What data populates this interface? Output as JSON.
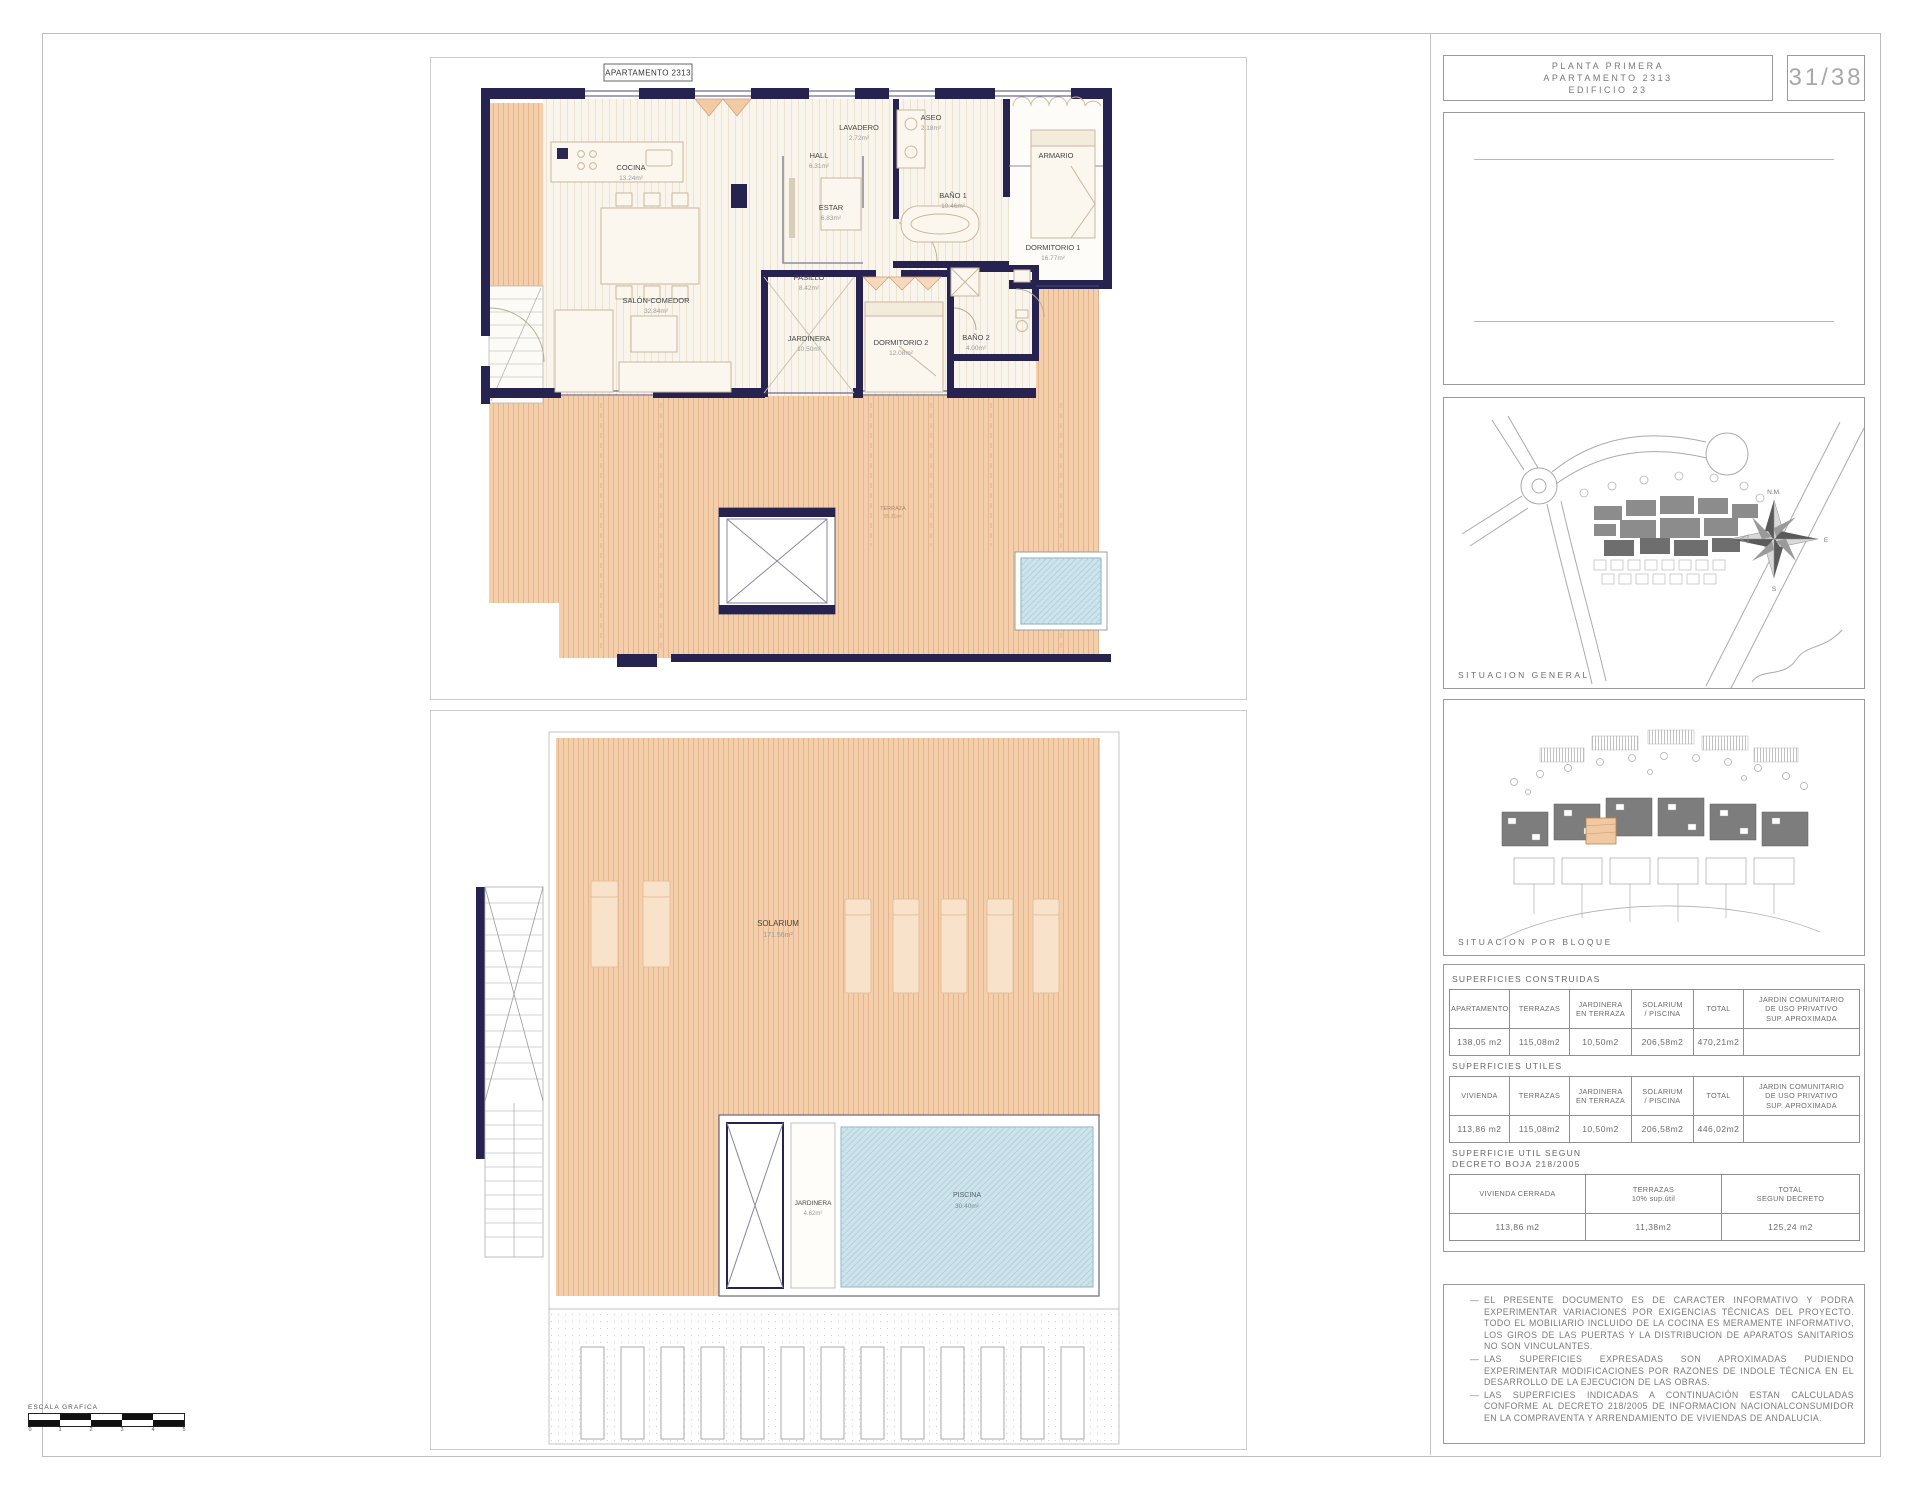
{
  "title_block": {
    "line1": "PLANTA  PRIMERA",
    "line2": "APARTAMENTO    2313",
    "line3": "EDIFICIO  23",
    "page": "31/38"
  },
  "plan1": {
    "tag": "APARTAMENTO 2313",
    "rooms": [
      {
        "name": "COCINA",
        "area": "13.24m²"
      },
      {
        "name": "HALL",
        "area": "6.31m²"
      },
      {
        "name": "LAVADERO",
        "area": "2.72m²"
      },
      {
        "name": "ASEO",
        "area": "2.18m²"
      },
      {
        "name": "ESTAR",
        "area": "6.83m²"
      },
      {
        "name": "BAÑO 1",
        "area": "10.46m²"
      },
      {
        "name": "ARMARIO",
        "area": ""
      },
      {
        "name": "DORMITORIO 1",
        "area": "16.77m²"
      },
      {
        "name": "PASILLO",
        "area": "8.42m²"
      },
      {
        "name": "SALÓN-COMEDOR",
        "area": "32.84m²"
      },
      {
        "name": "JARDINERA",
        "area": "10.50m²"
      },
      {
        "name": "DORMITORIO 2",
        "area": "12.08m²"
      },
      {
        "name": "BAÑO 2",
        "area": "4.00m²"
      },
      {
        "name": "TERRAZA",
        "area": "95.31m²"
      }
    ]
  },
  "plan2": {
    "rooms": [
      {
        "name": "SOLARIUM",
        "area": "171.56m²"
      },
      {
        "name": "JARDINERA",
        "area": "4.62m²"
      },
      {
        "name": "PISCINA",
        "area": "30.40m²"
      }
    ]
  },
  "situation_general": {
    "caption": "SITUACION  GENERAL",
    "compass": {
      "north": "N.M.",
      "east": "E",
      "south": "S"
    }
  },
  "situation_bloque": {
    "caption": "SITUACION  POR  BLOQUE"
  },
  "tables": {
    "construidas": {
      "caption": "SUPERFICIES  CONSTRUIDAS",
      "headers": [
        "APARTAMENTO",
        "TERRAZAS",
        "JARDINERA\nEN TERRAZA",
        "SOLARIUM\n/ PISCINA",
        "TOTAL",
        "JARDIN COMUNITARIO\nDE USO PRIVATIVO\nSUP. APROXIMADA"
      ],
      "values": [
        "138,05 m2",
        "115,08m2",
        "10,50m2",
        "206,58m2",
        "470,21m2",
        ""
      ]
    },
    "utiles": {
      "caption": "SUPERFICIES  UTILES",
      "headers": [
        "VIVIENDA",
        "TERRAZAS",
        "JARDINERA\nEN TERRAZA",
        "SOLARIUM\n/ PISCINA",
        "TOTAL",
        "JARDIN COMUNITARIO\nDE USO PRIVATIVO\nSUP. APROXIMADA"
      ],
      "values": [
        "113,86 m2",
        "115,08m2",
        "10,50m2",
        "206,58m2",
        "446,02m2",
        ""
      ]
    },
    "decreto": {
      "caption": "SUPERFICIE UTIL SEGUN\nDECRETO BOJA 218/2005",
      "headers": [
        "VIVIENDA CERRADA",
        "TERRAZAS\n10% sup.útil",
        "TOTAL\nSEGUN DECRETO"
      ],
      "values": [
        "113,86 m2",
        "11,38m2",
        "125,24 m2"
      ]
    }
  },
  "notes": {
    "items": [
      "EL PRESENTE DOCUMENTO ES DE CARACTER INFORMATIVO Y PODRA EXPERIMENTAR VARIACIONES POR EXIGENCIAS TÉCNICAS DEL PROYECTO. TODO EL MOBILIARIO INCLUIDO DE LA COCINA ES MERAMENTE INFORMATIVO, LOS GIROS DE LAS PUERTAS Y LA DISTRIBUCION DE APARATOS SANITARIOS NO SON VINCULANTES.",
      "LAS SUPERFICIES EXPRESADAS SON APROXIMADAS PUDIENDO EXPERIMENTAR MODIFICACIONES POR RAZONES DE INDOLE TÉCNICA EN EL DESARROLLO DE LA EJECUCION DE LAS OBRAS.",
      "LAS SUPERFICIES INDICADAS A CONTINUACIÓN ESTAN CALCULADAS CONFORME AL DECRETO 218/2005 DE INFORMACION NACIONALCONSUMIDOR EN LA COMPRAVENTA Y ARRENDAMIENTO DE VIVIENDAS DE ANDALUCIA."
    ]
  },
  "scale_bar": {
    "label": "ESCALA GRAFICA",
    "ticks": [
      "0",
      "1",
      "2",
      "3",
      "4",
      "5"
    ]
  }
}
